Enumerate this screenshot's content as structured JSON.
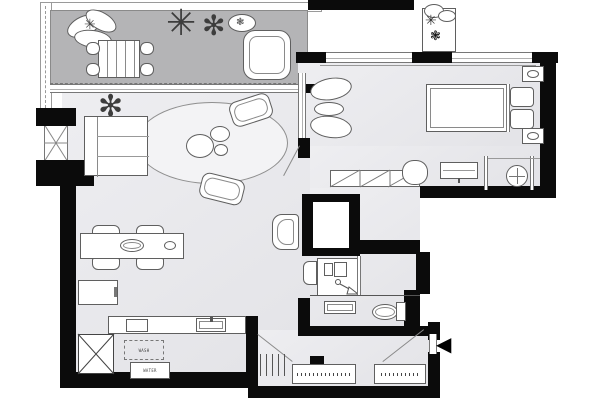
{
  "document": {
    "title": "Apartment Floor Plan"
  },
  "palette": {
    "background": "#ffffff",
    "wall": "#0b0b0b",
    "balcony_floor": "#b4b4b6",
    "interior_floor_light": "#eeeef1",
    "interior_floor_dark": "#e3e3e7",
    "furniture_fill": "#ffffff",
    "outline": "#5f5f5f",
    "rug_fill": "#f3f3f5",
    "entrance_arrow": "#000000"
  },
  "rooms": [
    {
      "id": "balcony"
    },
    {
      "id": "living-room"
    },
    {
      "id": "dining-area"
    },
    {
      "id": "kitchen"
    },
    {
      "id": "bedroom"
    },
    {
      "id": "dressing-room"
    },
    {
      "id": "study-nook"
    },
    {
      "id": "bathroom"
    },
    {
      "id": "entry-hall"
    }
  ],
  "labels": {
    "washer": "WASH",
    "water_heater": "WATER"
  },
  "symbols": {
    "entrance_arrow": "◀",
    "plant_star_large": "✳",
    "plant_star_small": "✻",
    "fan_plant": "✻",
    "planter_flower": "❃",
    "balcony_plant_core": "✳",
    "top_plant_a": "✳",
    "top_plant_b": "❃"
  }
}
